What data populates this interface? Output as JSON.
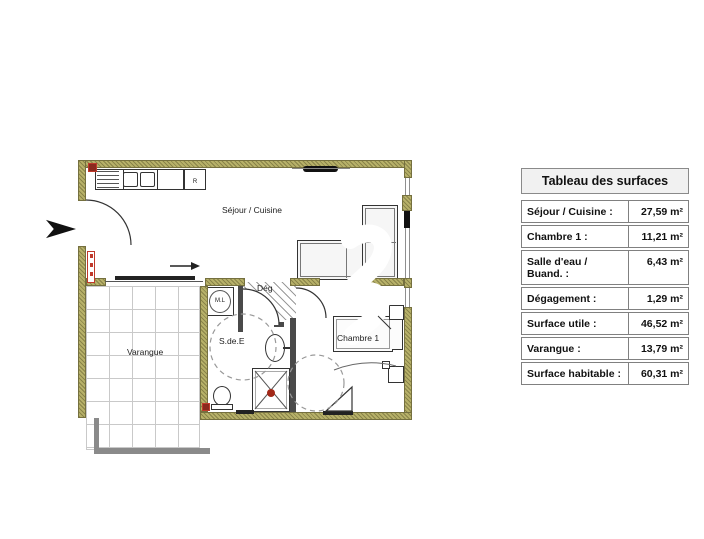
{
  "plan": {
    "labels": {
      "sejour": "Séjour / Cuisine",
      "varangue": "Varangue",
      "sde": "S.de.E",
      "deg": "Dég",
      "chambre": "Chambre 1",
      "ml": "M.L",
      "fridge": "R"
    }
  },
  "table": {
    "title": "Tableau des surfaces",
    "rows": [
      {
        "label": "Séjour / Cuisine :",
        "value": "27,59 m²"
      },
      {
        "label": "Chambre 1 :",
        "value": "11,21 m²"
      },
      {
        "label": "Salle d'eau / Buand. :",
        "value": "6,43 m²"
      },
      {
        "label": "Dégagement :",
        "value": "1,29 m²"
      },
      {
        "label": "Surface utile :",
        "value": "46,52 m²"
      },
      {
        "label": "Varangue :",
        "value": "13,79 m²"
      },
      {
        "label": "Surface habitable :",
        "value": "60,31 m²"
      }
    ]
  },
  "colors": {
    "wall": "#b7b169",
    "partition": "#4a4a4a",
    "accent_red": "#c0392b",
    "grid_line": "#c9c9c9"
  }
}
